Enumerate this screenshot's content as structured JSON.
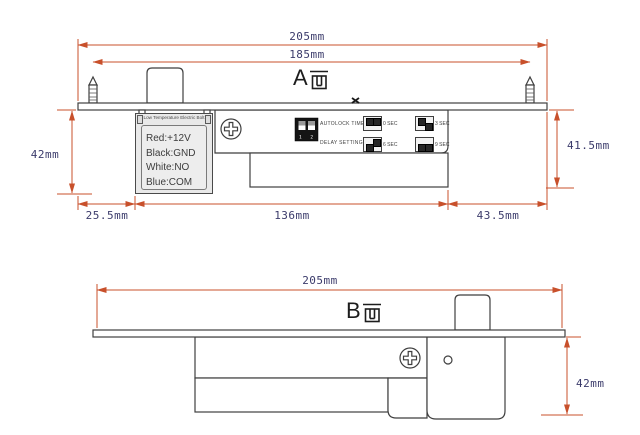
{
  "drawing_title": "Electric bolt lock dimension drawing",
  "colors": {
    "outline": "#3f3f3f",
    "dimension_line": "#c8502b",
    "dimension_text": "#3b3b6b",
    "label_box_fill": "#e9e9e9",
    "dip_block": "#141414"
  },
  "view_a": {
    "label": "A面",
    "letter": "A",
    "dim_total": "205mm",
    "dim_screw_spacing": "185mm",
    "dim_height_left": "42mm",
    "dim_height_right": "41.5mm",
    "dim_offset_left": "25.5mm",
    "dim_body": "136mm",
    "dim_offset_right": "43.5mm",
    "label_box": {
      "header": "Low Temperature Electric Bolt",
      "lines": [
        "Red:+12V",
        "Black:GND",
        "White:NO",
        "Blue:COM"
      ]
    },
    "dip_panel": {
      "row1_label": "AUTOLOCK TIME",
      "row2_label": "DELAY SETTING",
      "switch_numbers": "1 2",
      "settings": [
        {
          "label": "0 SEC",
          "positions": [
            "up",
            "up"
          ]
        },
        {
          "label": "3 SEC",
          "positions": [
            "up",
            "down"
          ]
        },
        {
          "label": "6 SEC",
          "positions": [
            "down",
            "up"
          ]
        },
        {
          "label": "9 SEC",
          "positions": [
            "down",
            "down"
          ]
        }
      ]
    }
  },
  "view_b": {
    "label": "B面",
    "letter": "B",
    "dim_total": "205mm",
    "dim_height": "42mm"
  }
}
